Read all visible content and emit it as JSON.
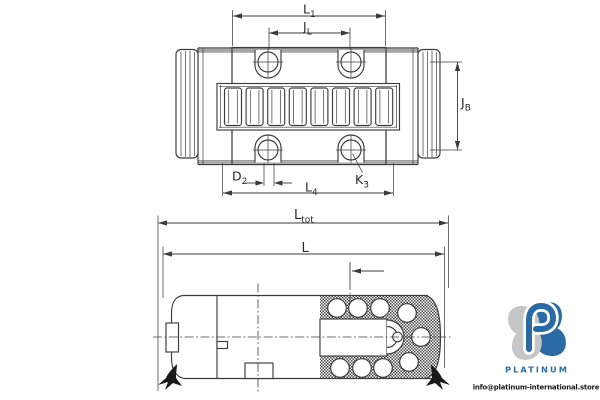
{
  "drawing": {
    "line_color": "#3c3c3c",
    "labels": {
      "l1": {
        "main": "L",
        "sub": "1"
      },
      "jl": {
        "main": "J",
        "sub": "L"
      },
      "jb": {
        "main": "J",
        "sub": "B"
      },
      "d2": {
        "main": "D",
        "sub": "2"
      },
      "k3": {
        "main": "K",
        "sub": "3"
      },
      "l4": {
        "main": "L",
        "sub": "4"
      },
      "ltot": {
        "main": "L",
        "sub": "tot"
      },
      "l": {
        "main": "L",
        "sub": ""
      }
    }
  },
  "watermark": {
    "brand": "PLATINUM",
    "email": "info@platinum-international.store",
    "brand_color": "#2d6ca2",
    "email_color": "#1c1c1c",
    "logo_blue": "#2a6aa5",
    "logo_gray": "#c6c6c6"
  }
}
